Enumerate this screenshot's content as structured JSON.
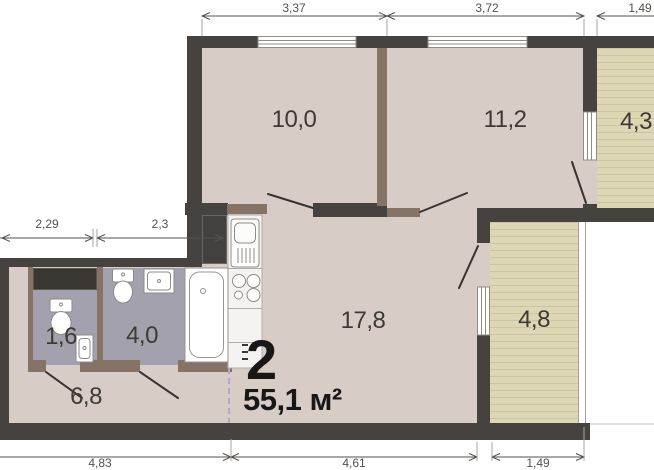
{
  "plan": {
    "unit": {
      "number": "2",
      "area": "55,1 м²"
    },
    "rooms": [
      {
        "key": "room10",
        "label": "10,0"
      },
      {
        "key": "room11",
        "label": "11,2"
      },
      {
        "key": "balcony43",
        "label": "4,3"
      },
      {
        "key": "room17",
        "label": "17,8"
      },
      {
        "key": "balcony48",
        "label": "4,8"
      },
      {
        "key": "wc",
        "label": "1,6"
      },
      {
        "key": "bath",
        "label": "4,0"
      },
      {
        "key": "hall",
        "label": "6,8"
      }
    ],
    "dimensions": {
      "top": [
        "3,37",
        "3,72",
        "1,49"
      ],
      "left": [
        "2,29",
        "2,3"
      ],
      "bottom": [
        "4,83",
        "4,61",
        "1,49"
      ]
    },
    "icons": [
      "bathtub-icon",
      "toilet-icon",
      "sink-icon",
      "stove-icon",
      "kitchen-sink-icon",
      "fridge-icon",
      "wardrobe-icon",
      "window-icon",
      "door-swing-icon",
      "entry-dashed-line"
    ],
    "colors": {
      "wall": "#46423f",
      "partition": "#857465",
      "floor": "#d8ccc6",
      "wet_floor": "#a2a1ad",
      "balcony": "#ded7b5",
      "balcony_line": "#cdc5a1",
      "entry_dash": "#b7a5c7",
      "label_text": "#3e3a36",
      "dim_text": "#54504c",
      "unit_text": "#181715"
    }
  }
}
